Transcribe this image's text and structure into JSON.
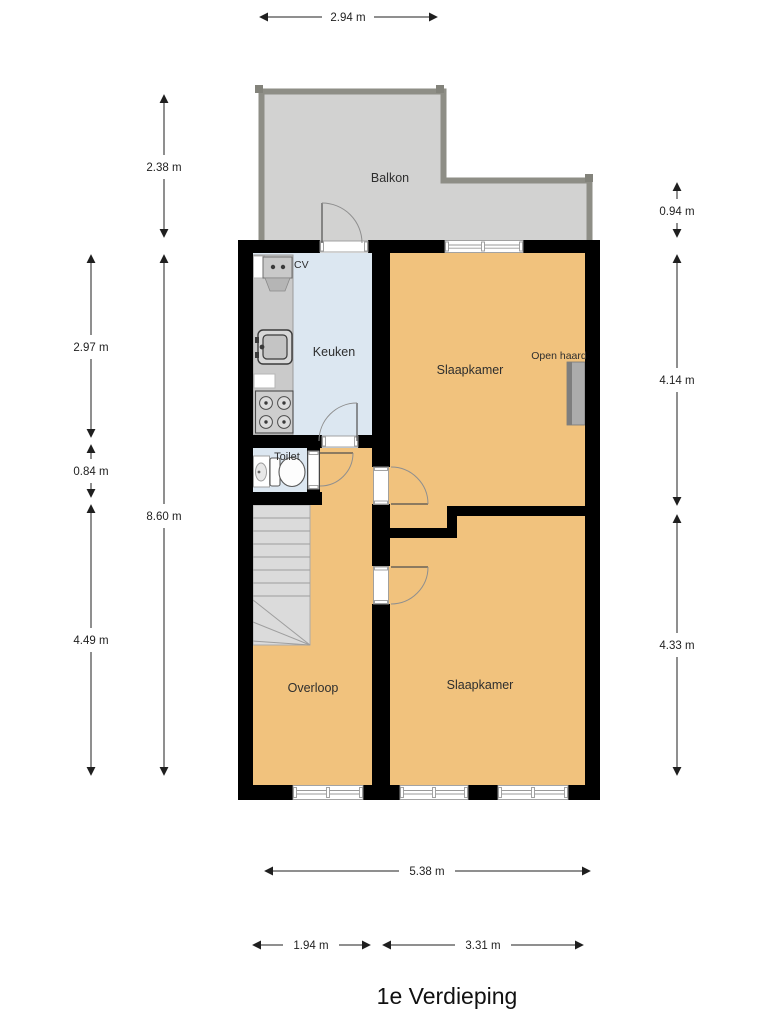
{
  "title": "1e Verdieping",
  "rooms": {
    "balkon": {
      "label": "Balkon"
    },
    "keuken": {
      "label": "Keuken"
    },
    "toilet": {
      "label": "Toilet"
    },
    "slaapkamer1": {
      "label": "Slaapkamer"
    },
    "slaapkamer2": {
      "label": "Slaapkamer"
    },
    "overloop": {
      "label": "Overloop"
    }
  },
  "annotations": {
    "cv": "CV",
    "open_haard": "Open haard"
  },
  "dimensions": {
    "balcony_width": "2.94 m",
    "balcony_height": "2.38 m",
    "kitchen_height": "2.97 m",
    "toilet_height": "0.84 m",
    "floor_height": "8.60 m",
    "overloop_height": "4.49 m",
    "balcony_right_height": "0.94 m",
    "bedroom1_height": "4.14 m",
    "bedroom2_height": "4.33 m",
    "floor_width": "5.38 m",
    "overloop_width": "1.94 m",
    "bedroom_width": "3.31 m"
  },
  "colors": {
    "floor_orange": "#F1C27D",
    "floor_blue": "#DCE7F1",
    "balcony_fill": "#D2D2D1",
    "balcony_border": "#8E8E86",
    "wall": "#000000",
    "stairs": "#DBDBDB",
    "fireplace": "#ACACAC",
    "dim_text": "#1F1F1F"
  }
}
